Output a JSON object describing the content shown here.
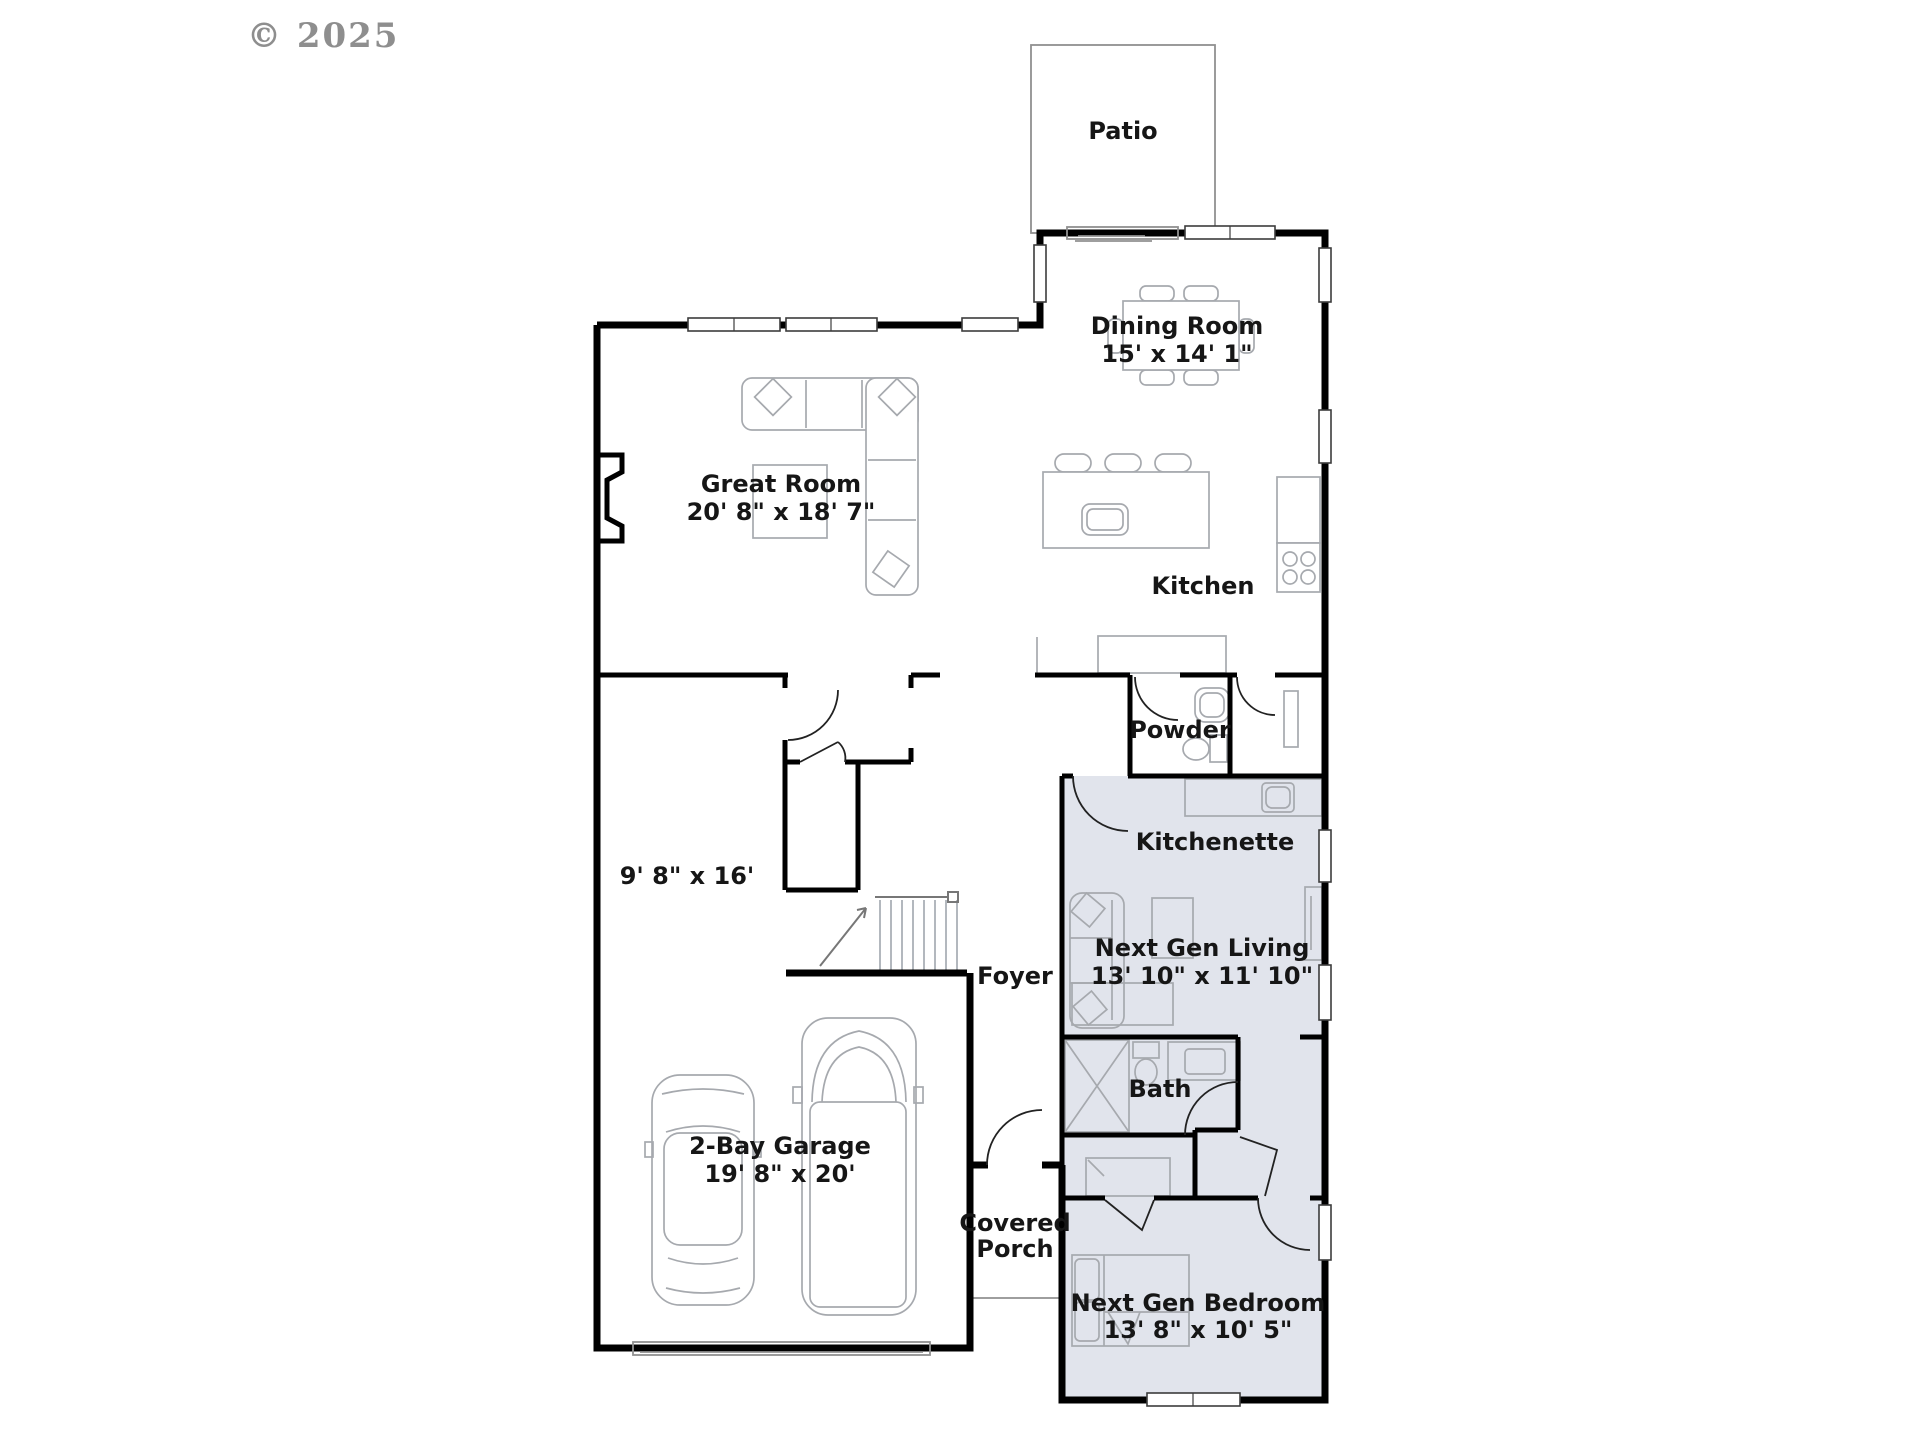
{
  "copyright": "© 2025",
  "colors": {
    "wall": "#000000",
    "suite_fill": "#e1e4ec",
    "furniture_line": "#a6a9ae",
    "label_text": "#161616",
    "copyright_text": "#8e8e8e"
  },
  "rooms": {
    "patio": {
      "name": "Patio"
    },
    "dining": {
      "name": "Dining Room",
      "dims": "15' x 14' 1\""
    },
    "great": {
      "name": "Great Room",
      "dims": "20' 8\" x 18' 7\""
    },
    "kitchen": {
      "name": "Kitchen"
    },
    "powder": {
      "name": "Powder"
    },
    "kitchenette": {
      "name": "Kitchenette"
    },
    "next_gen_living": {
      "name": "Next Gen Living",
      "dims": "13' 10\" x 11' 10\""
    },
    "flex": {
      "dims": "9' 8\" x 16'"
    },
    "foyer": {
      "name": "Foyer"
    },
    "bath": {
      "name": "Bath"
    },
    "garage": {
      "name": "2-Bay Garage",
      "dims": "19' 8\" x 20'"
    },
    "covered_porch": {
      "name_line1": "Covered",
      "name_line2": "Porch"
    },
    "next_gen_bedroom": {
      "name": "Next Gen Bedroom",
      "dims": "13' 8\" x 10' 5\""
    }
  }
}
